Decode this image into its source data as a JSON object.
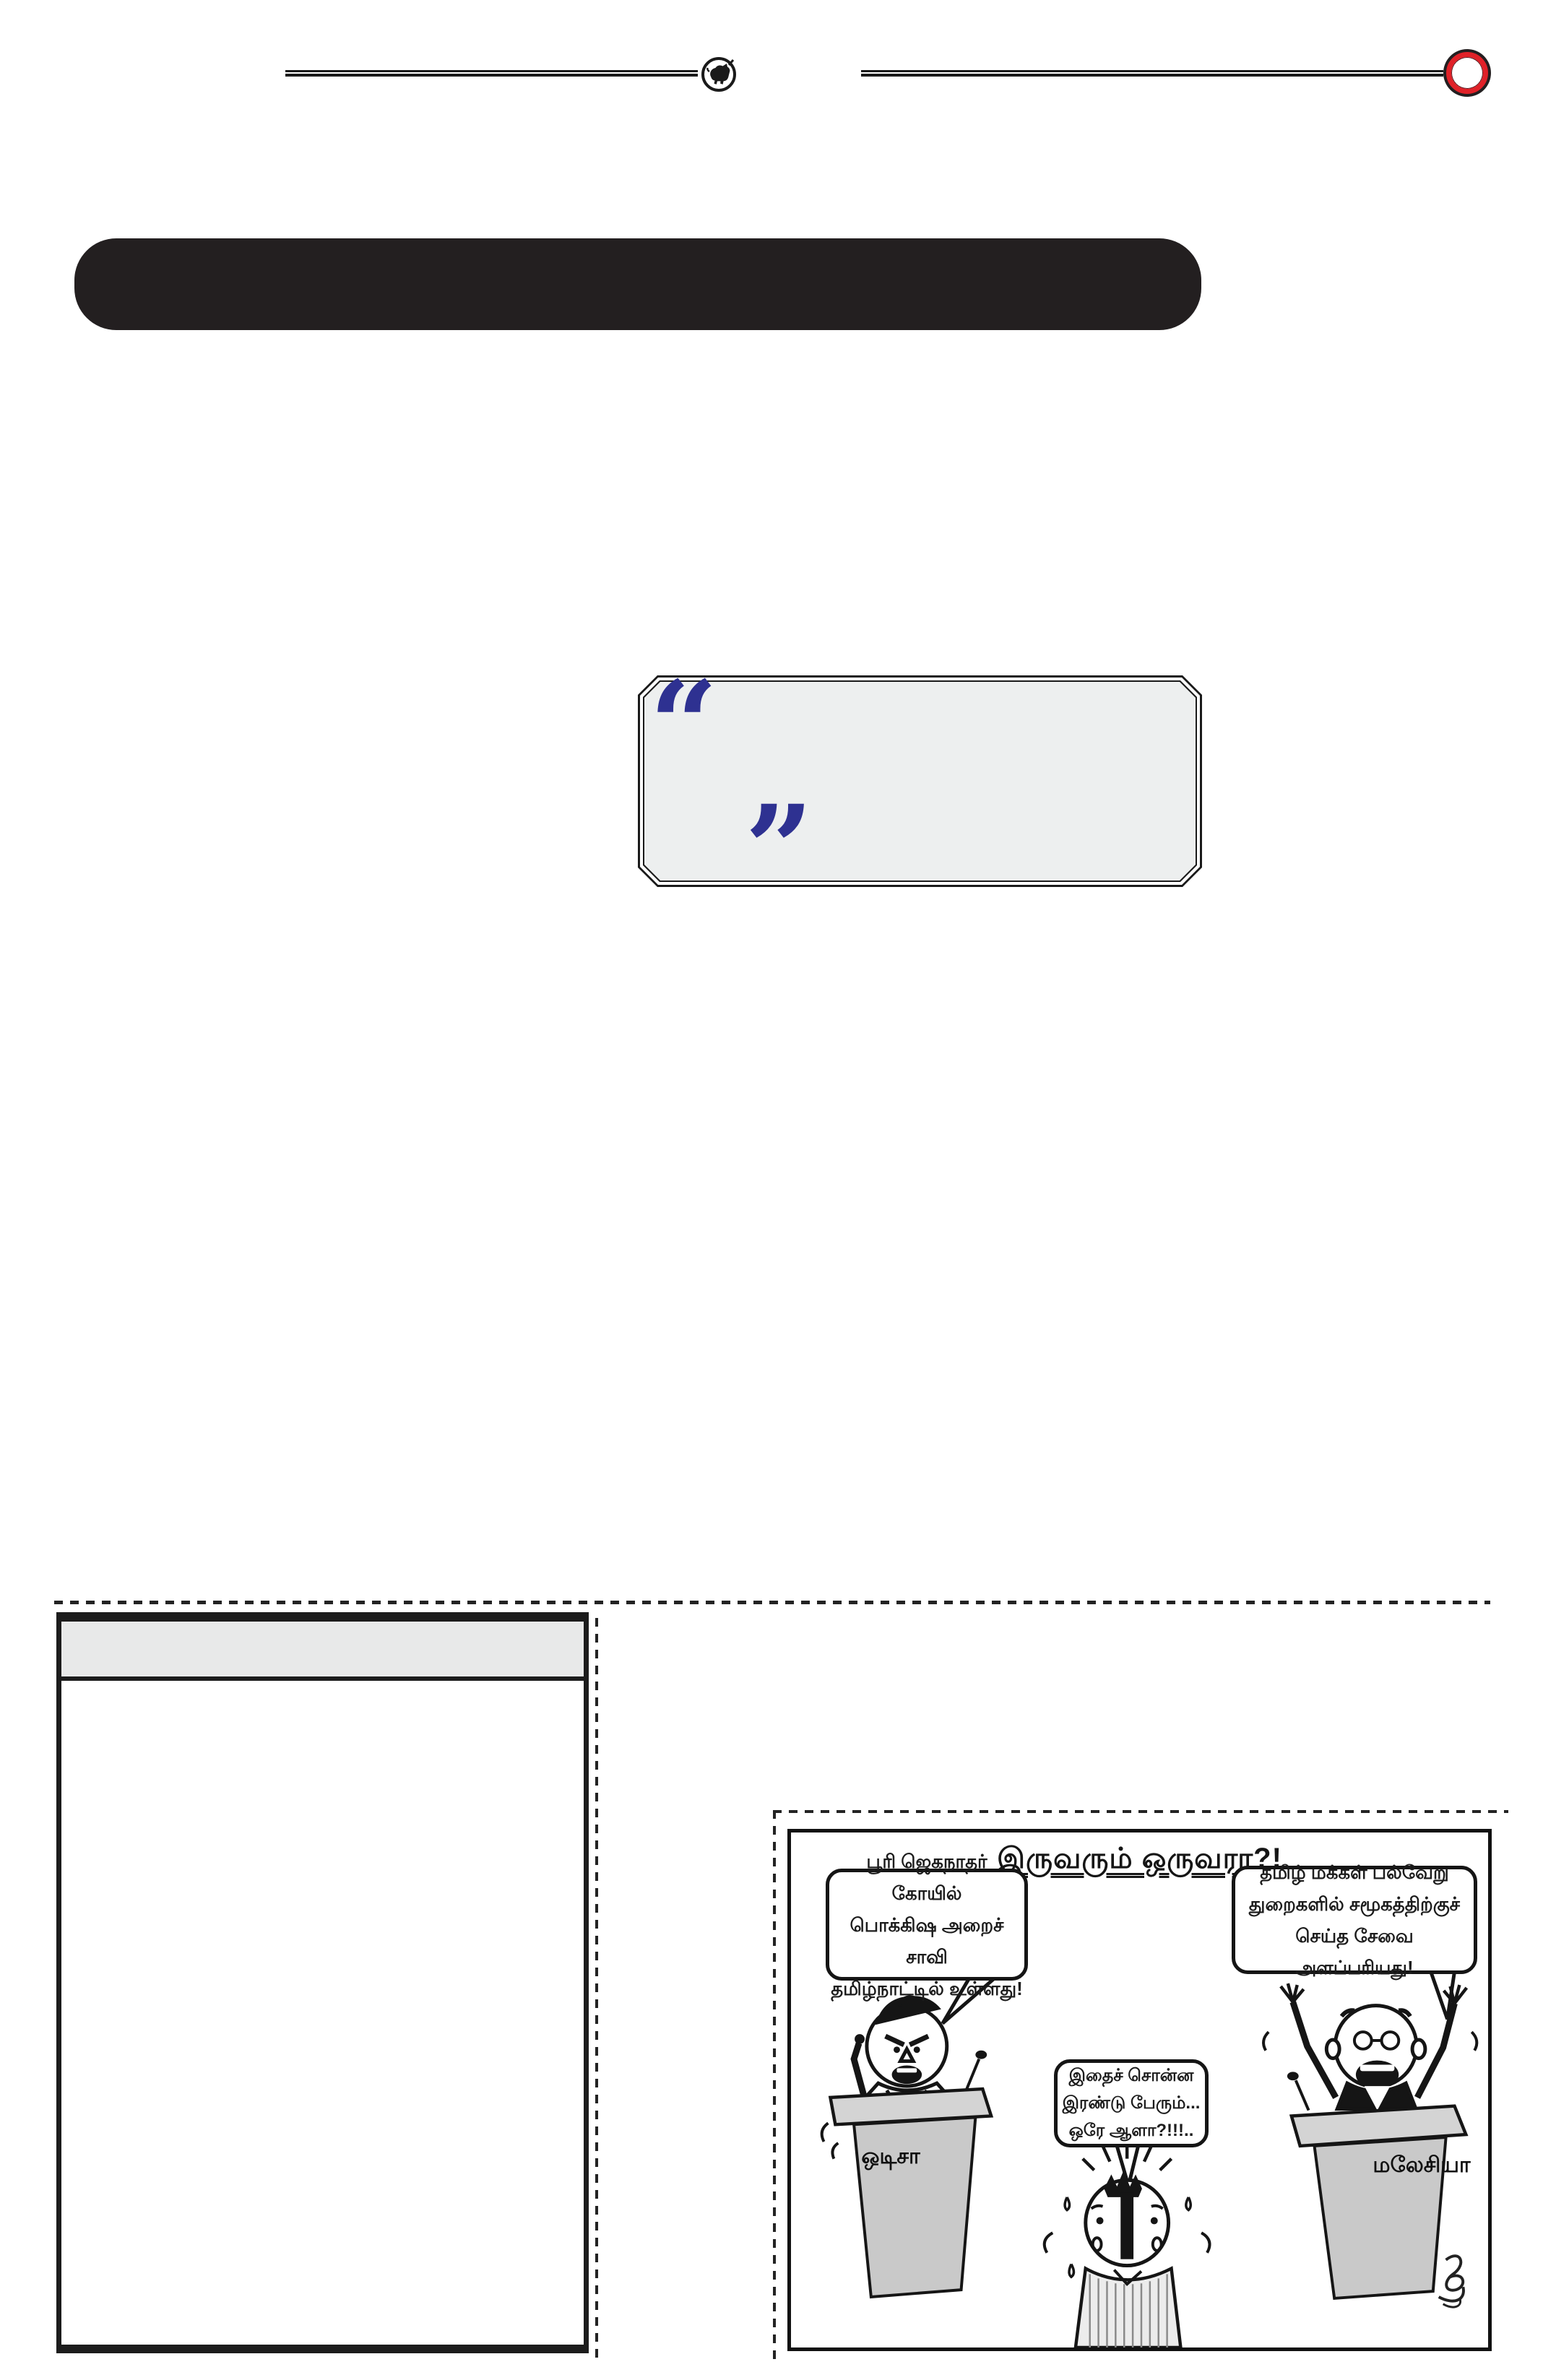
{
  "masthead": {
    "icons": {
      "bull_emblem": "bull-in-circle",
      "red_seal": "red-ring-circle"
    }
  },
  "banner": {
    "style": "black-rounded-title-bar"
  },
  "quote": {
    "open_mark": "“",
    "close_mark": "”"
  },
  "article_box": {
    "header": "",
    "body": ""
  },
  "cartoon": {
    "title": "இருவரும் ஒருவரா?!",
    "left_bubble": [
      "பூரி ஜெகநாதர் கோயில்",
      "பொக்கிஷ அறைச் சாவி",
      "தமிழ்நாட்டில் உள்ளது!"
    ],
    "right_bubble": [
      "தமிழ் மக்கள் பல்வேறு",
      "துறைகளில் சமூகத்திற்குச்",
      "செய்த சேவை அளப்பரியது!"
    ],
    "middle_bubble": [
      "இதைச் சொன்ன",
      "இரண்டு பேரும்...",
      "ஒரே ஆளா?!!!.."
    ],
    "left_podium_label": "ஒடிசா",
    "right_podium_label": "மலேசியா",
    "signature_icon": "artist-signature-squiggle"
  },
  "colors": {
    "ink": "#231f20",
    "quote_navy": "#2e3191",
    "seal_red": "#e02128",
    "quote_box_fill": "#edefef",
    "header_fill": "#e8e9e9"
  }
}
